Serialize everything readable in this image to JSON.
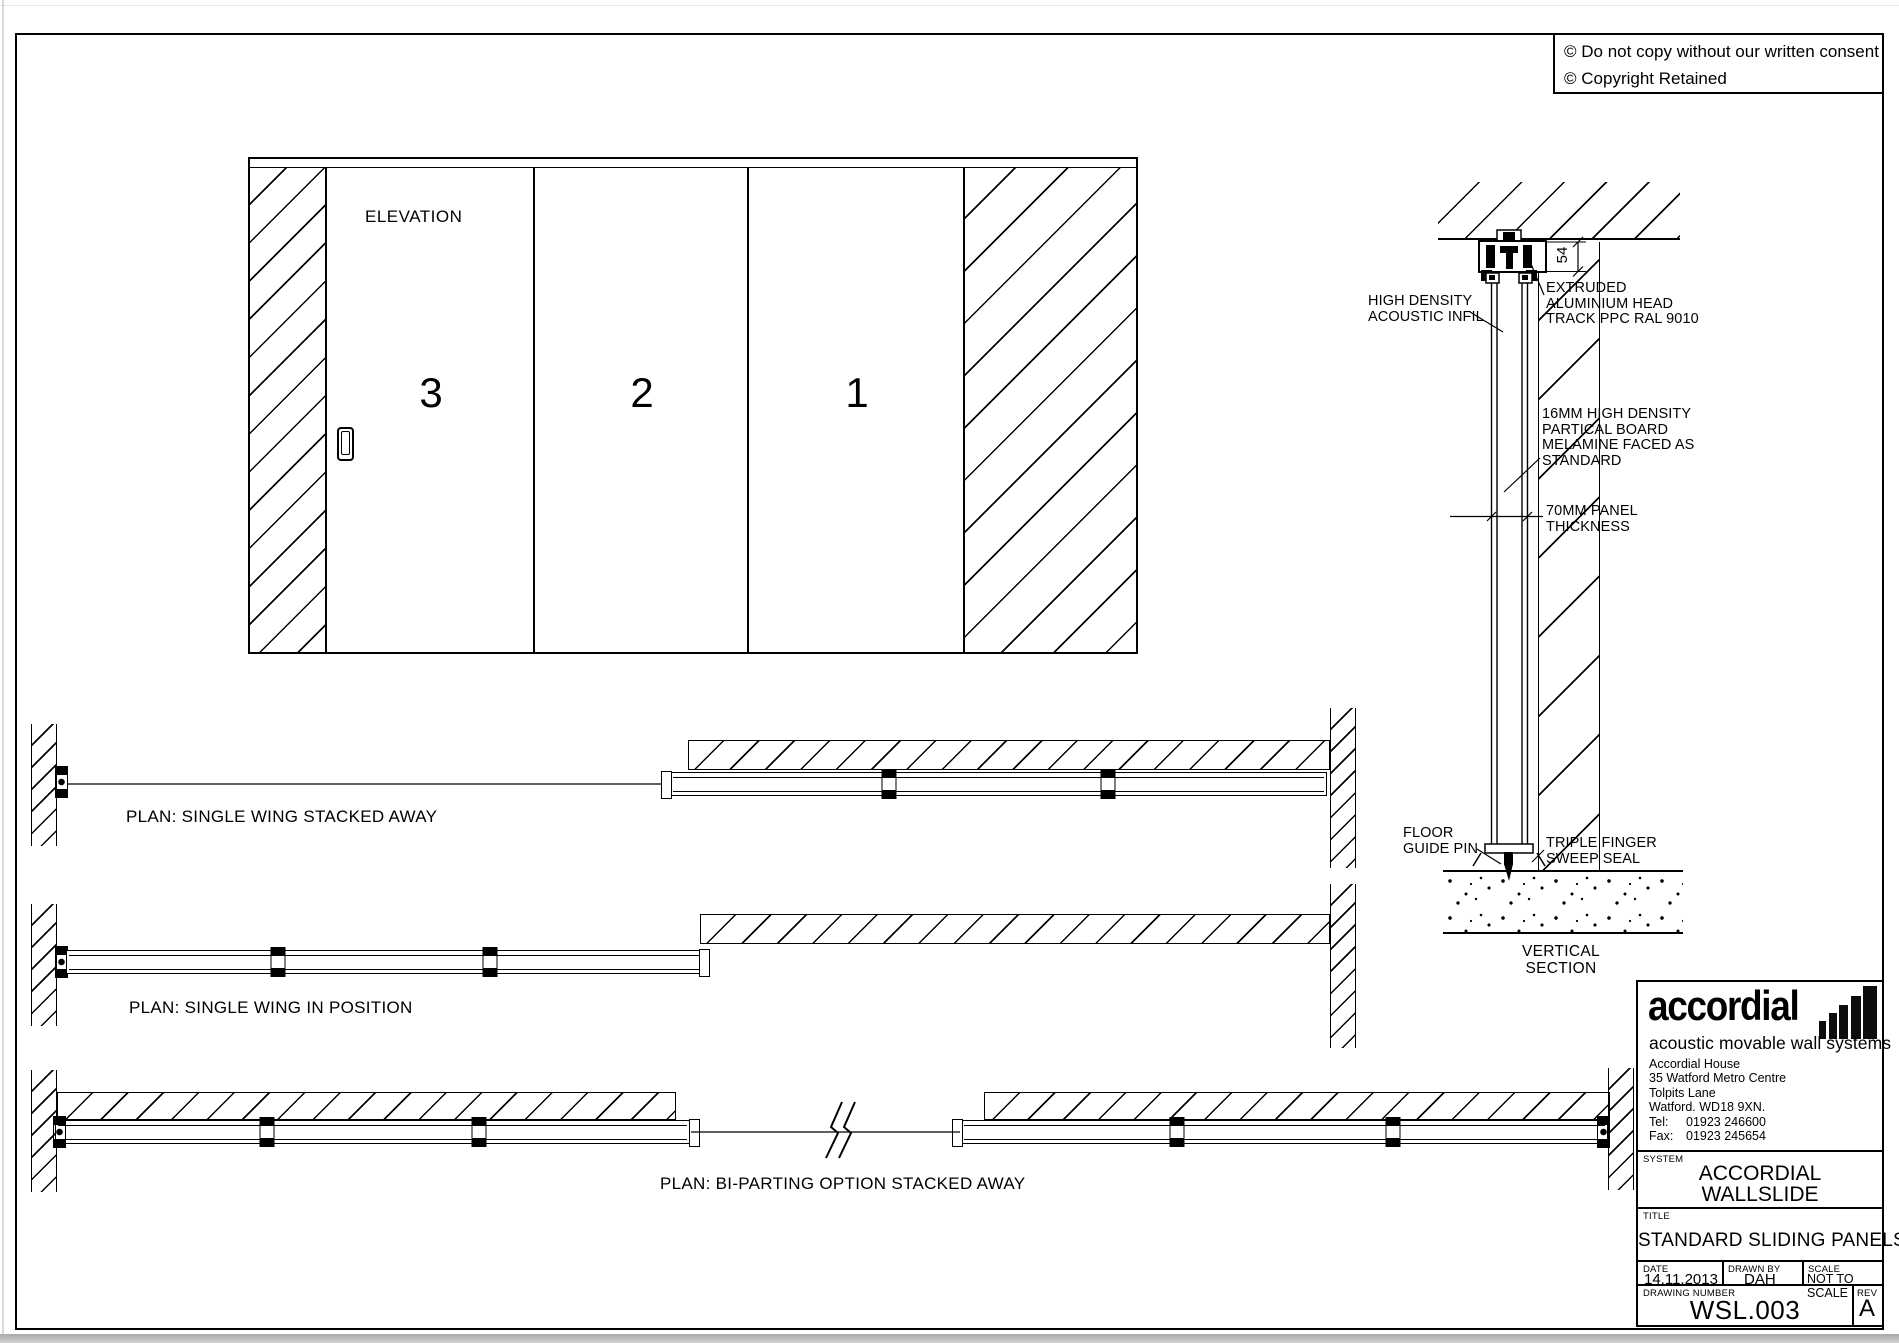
{
  "page": {
    "copyright_symbol": "©",
    "copyright_line1": "Do not copy without our written consent",
    "copyright_line2": "Copyright Retained"
  },
  "elevation": {
    "label": "ELEVATION",
    "panel_numbers": [
      "3",
      "2",
      "1"
    ]
  },
  "vertical_section": {
    "head_dimension": "54",
    "acoustic_infil": [
      "HIGH DENSITY",
      "ACOUSTIC INFIL"
    ],
    "head_track": [
      "EXTRUDED",
      "ALUMINIUM HEAD",
      "TRACK PPC RAL 9010"
    ],
    "board": [
      "16MM HIGH DENSITY",
      "PARTICAL BOARD",
      "MELAMINE FACED AS",
      "STANDARD"
    ],
    "thickness": [
      "70MM PANEL",
      "THICKNESS"
    ],
    "floor_pin": [
      "FLOOR",
      "GUIDE PIN"
    ],
    "sweep_seal": [
      "TRIPLE FINGER",
      "SWEEP SEAL"
    ],
    "caption": [
      "VERTICAL",
      "SECTION"
    ]
  },
  "plans": [
    {
      "label": "PLAN: SINGLE WING STACKED AWAY"
    },
    {
      "label": "PLAN: SINGLE WING IN POSITION"
    },
    {
      "label": "PLAN: BI-PARTING OPTION STACKED AWAY"
    }
  ],
  "title_block": {
    "logo": "accordial",
    "tagline": "acoustic movable wall systems",
    "address": [
      "Accordial House",
      "35 Watford Metro Centre",
      "Tolpits Lane",
      "Watford. WD18 9XN."
    ],
    "tel_label": "Tel:",
    "tel": "01923 246600",
    "fax_label": "Fax:",
    "fax": "01923 245654",
    "system_label": "SYSTEM",
    "system": [
      "ACCORDIAL",
      "WALLSLIDE"
    ],
    "title_label": "TITLE",
    "title": "STANDARD SLIDING PANELS",
    "date_label": "DATE",
    "date": "14.11.2013",
    "drawn_by_label": "DRAWN BY",
    "drawn_by": "DAH",
    "scale_label": "SCALE",
    "scale": "NOT TO SCALE",
    "drawing_number_label": "DRAWING NUMBER",
    "drawing_number": "WSL.003",
    "rev_label": "REV",
    "rev": "A"
  }
}
